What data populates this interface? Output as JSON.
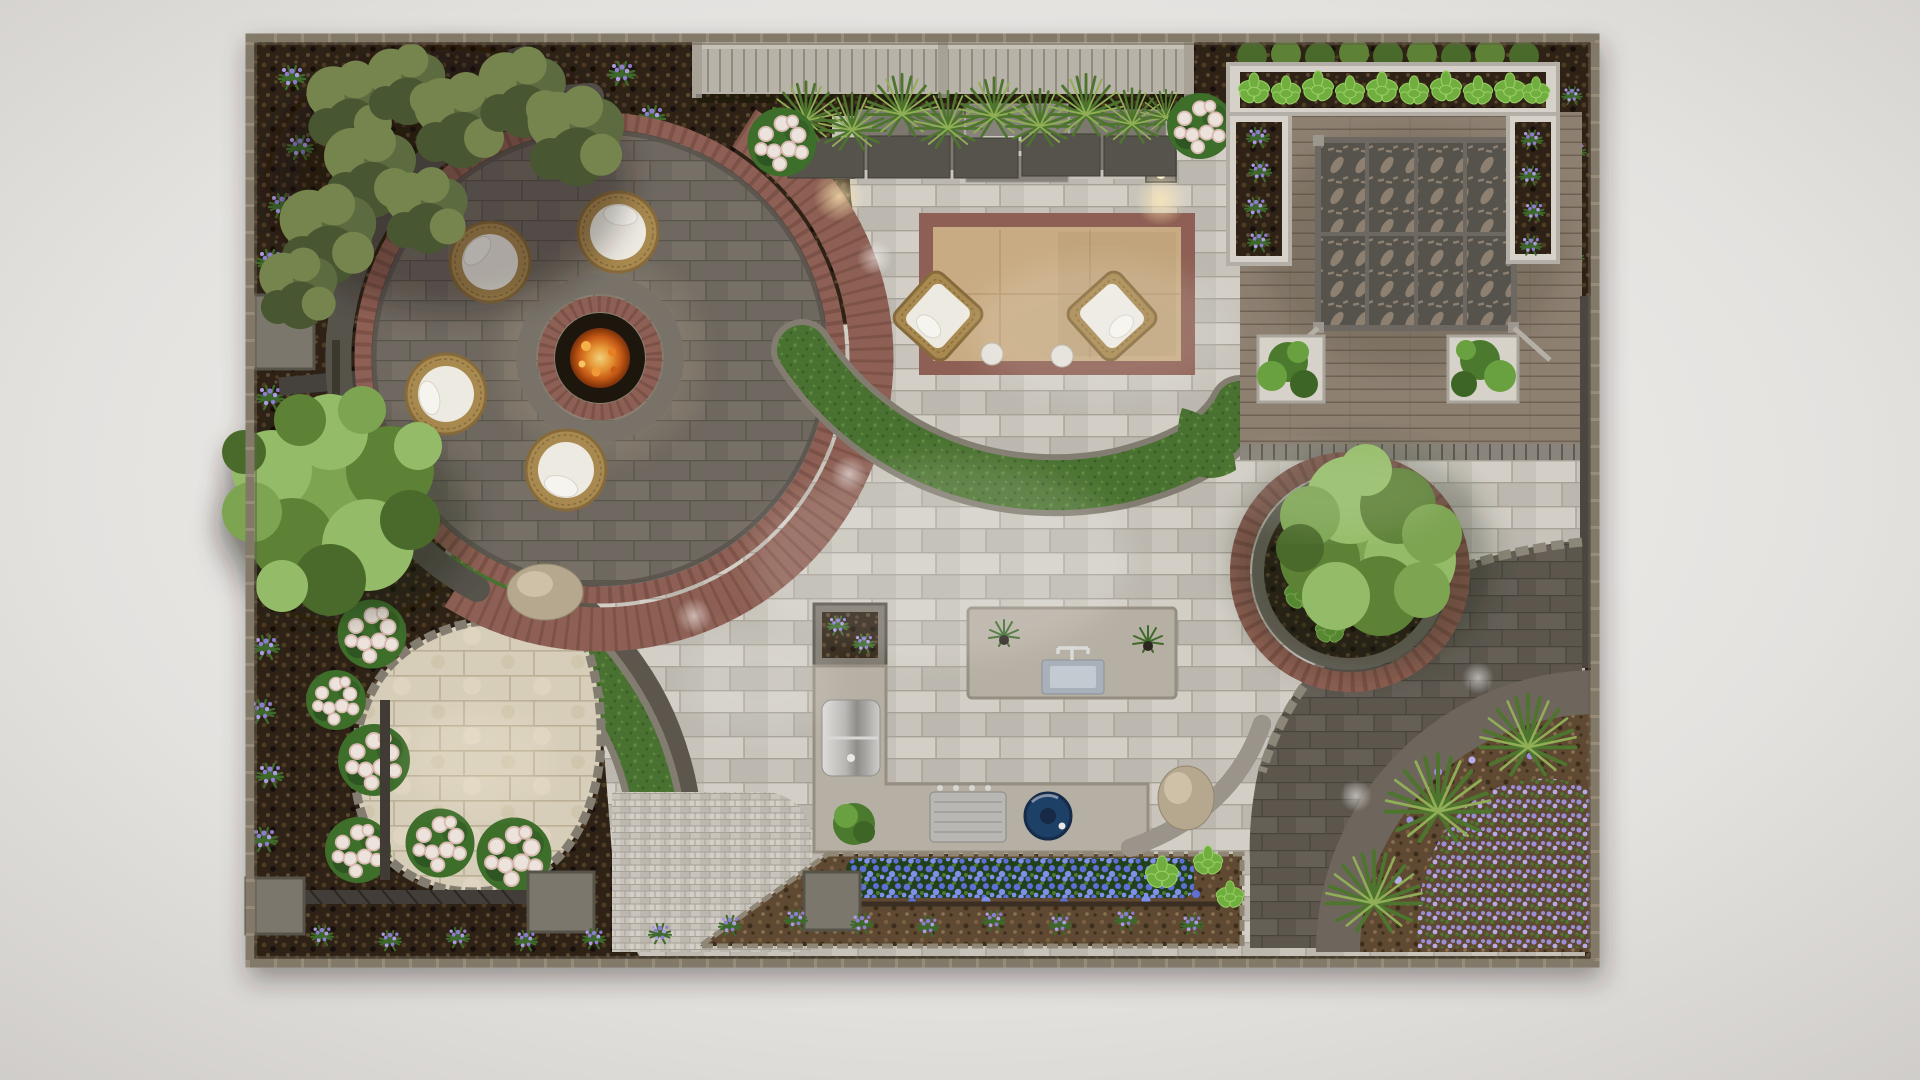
{
  "scene": {
    "type": "3d-landscape-design-render",
    "view": "top-down plan view of a residential backyard",
    "zones": [
      {
        "id": "fire-pit-patio",
        "label": "circular fire pit lounge with 4 round wicker chairs"
      },
      {
        "id": "lounge-patio",
        "label": "conversation patio with outdoor sofa, fireplace, area rug and 2 wicker armchairs"
      },
      {
        "id": "pergola-deck",
        "label": "wood deck with laser-cut leaf-pattern pergola panels and planters"
      },
      {
        "id": "raised-planters",
        "label": "white raised beds with hostas and lavender"
      },
      {
        "id": "shade-tree-circle",
        "label": "brick-edged circular bed with large shade tree"
      },
      {
        "id": "outdoor-kitchen",
        "label": "L-shaped kitchen with grill, griddle, blue kamado and sink island"
      },
      {
        "id": "corner-garden",
        "label": "quarter-circle raised bed with fountain grasses and purple groundcover"
      },
      {
        "id": "teardrop-patio",
        "label": "travertine teardrop patio"
      },
      {
        "id": "lawn-ribbons",
        "label": "curved lawn bands with cobble edging"
      },
      {
        "id": "hydrangea-border",
        "label": "white hydrangea bed with bench and cube planters"
      },
      {
        "id": "mulch-perimeter",
        "label": "dark mulch borders with olive trees and lavender"
      },
      {
        "id": "privacy-fence",
        "label": "horizontal slat privacy fence with ornamental grass planters"
      },
      {
        "id": "flower-border",
        "label": "blue annual flower strip along the kitchen"
      }
    ],
    "furniture_counts": {
      "round_lounge_chairs": 4,
      "wicker_armchairs": 2,
      "sofa_modules": 2,
      "pergola_panels": 8,
      "deck_planters": 2,
      "cube_planters": 5,
      "pillar_lights": 2,
      "fountain_grasses": 3,
      "hydrangea_shrubs": 8,
      "olive_trees": 9
    }
  },
  "palette": {
    "bg_hi": "#f3f2f0",
    "bg_lo": "#c9c6c2",
    "stone_border": "#968c79",
    "stone_border_dark": "#6e6557",
    "wall_dark": "#4b463f",
    "mulch_base": "#2e2214",
    "mulch_fleck1": "#4e3a24",
    "mulch_fleck2": "#190f07",
    "mulch_fleck3": "#5c4830",
    "mulch_light": "#5e4a31",
    "mulch_lfl1": "#7a6142",
    "mulch_lfl2": "#3d2d1c",
    "mulch_lfl3": "#8a7252",
    "paver_light": "#c8c4bb",
    "paver_light_alt1": "#d3cfc7",
    "paver_light_alt2": "#bcb8af",
    "paver_light_line": "#a7a298",
    "paver_mid": "#6e6860",
    "paver_mid_alt": "#776f66",
    "paver_mid_line": "#59544c",
    "paver_dark": "#5b564e",
    "paver_dark_alt": "#655f57",
    "paver_dark_line": "#48443d",
    "brick": "#8e6054",
    "brick_joint": "#70473d",
    "lawn": "#4a7230",
    "lawn_dark": "#3a5c24",
    "lawn_light": "#5f8a3e",
    "edging": "#837d71",
    "deck": "#8d8071",
    "deck_line": "#6e6254",
    "lattice": "#55524b",
    "lattice_cut": "#8d8071",
    "lattice_frame": "#6d6962",
    "planter_white": "#d6d2c9",
    "planter_gray": "#7c776d",
    "planter_gray_dark": "#57534a",
    "travertine": "#d7ceb9",
    "travertine_line": "#bbaf95",
    "counter": "#b6afa3",
    "counter_shade": "#968e81",
    "kamado": "#1f3f66",
    "kamado_dark": "#122944",
    "sink": "#a8b0ba",
    "sink_light": "#c4cad2",
    "fire_pit": "#1d130b",
    "fire_glow": "#f2a23c",
    "fire_core": "#d25f17",
    "wicker": "#a8894f",
    "wicker_dark": "#876a3a",
    "cushion": "#edeae2",
    "sofa": "#7b786f",
    "sofa_trim": "#c8c4bb",
    "fireplace": "#87837b",
    "fireplace_band": "#cdc9c0",
    "olive1": "#5d6c3f",
    "olive2": "#74854e",
    "olive3": "#485631",
    "tree1": "#7ca451",
    "tree2": "#94bc67",
    "tree3": "#5d8136",
    "tree4": "#4a6b2a",
    "shrub": "#4c7a2f",
    "shrub_light": "#69a03f",
    "hosta": "#6fae3f",
    "hosta_light": "#98cf62",
    "grass": "#4e742e",
    "grass_light": "#8fae55",
    "lav_green": "#3e6b2b",
    "lav_purple": "#8b7ed0",
    "lav_purple2": "#aa9de2",
    "blue1": "#5b6fd6",
    "blue2": "#7e90ea",
    "blue_fol": "#24401c",
    "hyd_white": "#ece3dc",
    "hyd_pink": "#d9bab2",
    "hyd_green": "#3e6e2c",
    "boulder": "#b5a88f",
    "boulder_light": "#cec1a7",
    "gc1": "#9a8ed9",
    "gc2": "#b7abe8",
    "fence": "#b8b3a9",
    "fence_line": "#918b7f",
    "fence_rail": "#c6c1b7",
    "steel_hi": "#dedddb",
    "steel_lo": "#8e8d89"
  }
}
